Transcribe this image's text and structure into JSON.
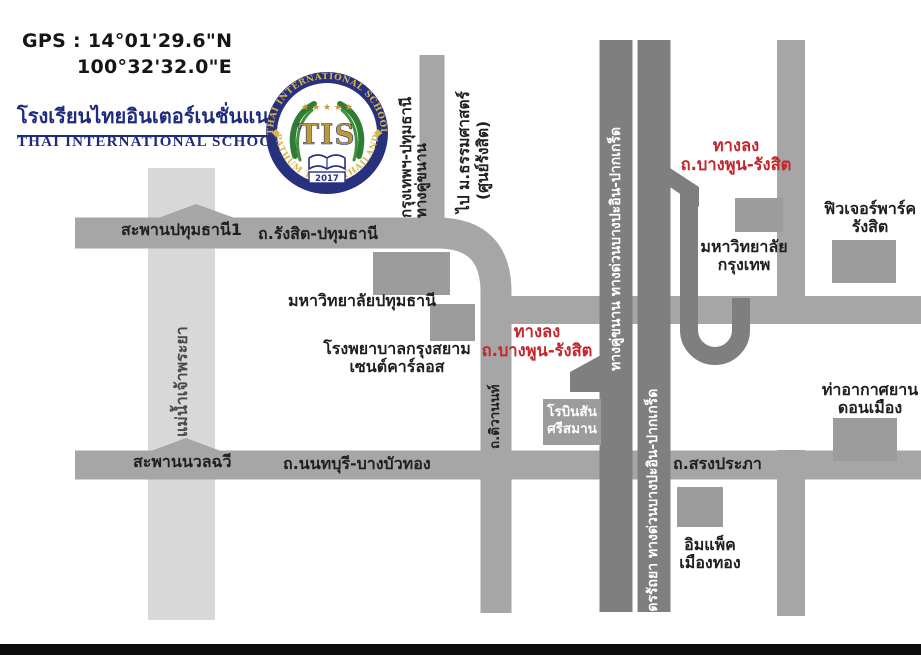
{
  "header": {
    "gps_line1": "GPS : 14°01'29.6\"N",
    "gps_line2": "100°32'32.0\"E",
    "school_name_th": "โรงเรียนไทยอินเตอร์เนชั่นแนลสกูล",
    "school_name_en": "THAI INTERNATIONAL SCHOOL"
  },
  "logo": {
    "ring_top": "THAI INTERNATIONAL SCHOOL",
    "ring_bottom": "PATHUM THANI THAILAND",
    "stars": "★ ★ ★ ★ ★",
    "monogram": "TIS",
    "year": "2017"
  },
  "map": {
    "river_label": "แม่น้ำเจ้าพระยา",
    "bridge_pathumthani": "สะพานปทุมธานี1",
    "road_rangsit_pathumthani": "ถ.รังสิต-ปทุมธานี",
    "parallel_road_line1": "กรุงเทพฯ-ปทุมธานี",
    "parallel_road_line2": "ทางคู่ขนาน",
    "to_thammasat_line1": "ไป ม.ธรรมศาสตร์",
    "to_thammasat_line2": "(ศูนย์รังสิต)",
    "pathumthani_university": "มหาวิทยาลัยปทุมธานี",
    "hospital_line1": "โรงพยาบาลกรุงสยาม",
    "hospital_line2": "เซนต์คาร์ลอส",
    "exit_line1": "ทางลง",
    "exit_line2": "ถ.บางพูน-รังสิต",
    "road_tiwanon": "ถ.ติวานนท์",
    "robinson_line1": "โรบินสัน",
    "robinson_line2": "ศรีสมาน",
    "bridge_nuanchawee": "สะพานนวลฉวี",
    "road_nonthaburi_bangbuathong": "ถ.นนทบุรี-บางบัวทอง",
    "road_songprapha": "ถ.สรงประภา",
    "frontage_road_label": "ทางคู่ขนาน ทางด่วนบางปะอิน-ปากเกร็ด",
    "expressway_label": "อุดรรัถยา ทางด่วนบางปะอิน-ปากเกร็ด",
    "bangkok_university_line1": "มหาวิทยาลัย",
    "bangkok_university_line2": "กรุงเทพ",
    "future_park_line1": "ฟิวเจอร์พาร์ค",
    "future_park_line2": "รังสิต",
    "don_mueang_line1": "ท่าอากาศยาน",
    "don_mueang_line2": "ดอนเมือง",
    "impact_line1": "อิมแพ็ค",
    "impact_line2": "เมืองทอง"
  },
  "colors": {
    "road": "#a6a6a6",
    "road_dark": "#7f7f7f",
    "river": "#d8d8d8",
    "building": "#9c9c9c",
    "red_label": "#c2272b",
    "navy": "#1e2b7e",
    "gold": "#bd9a36",
    "green": "#2e7d32",
    "bottom_bar": "#0d0d0d"
  }
}
